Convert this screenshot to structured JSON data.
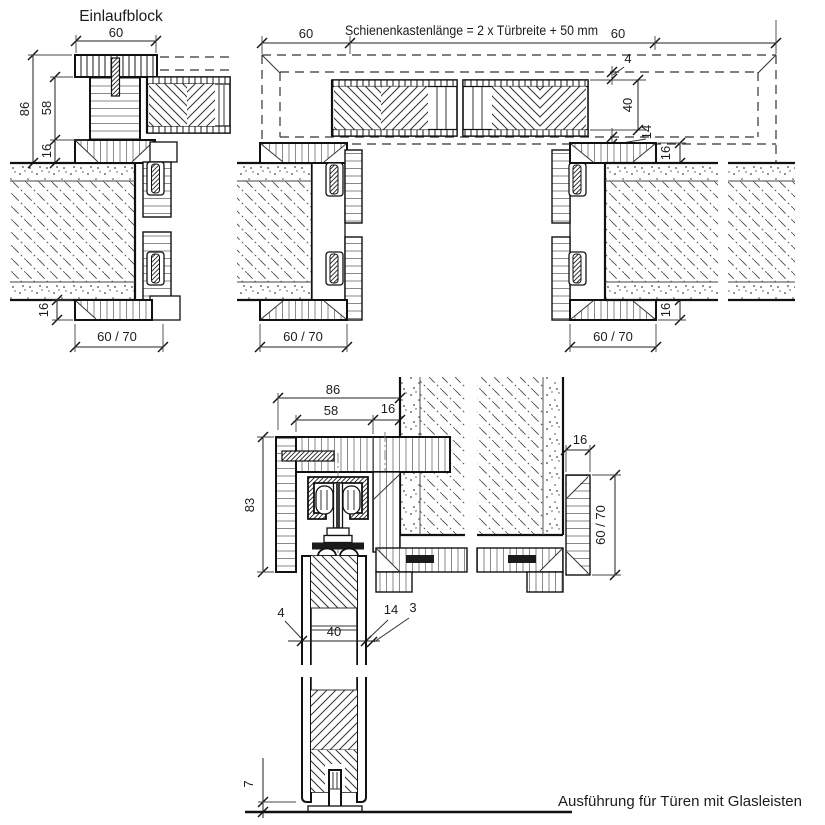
{
  "labels": {
    "einlaufblock": "Einlaufblock",
    "rail_box_formula": "Schienenkastenlänge = 2 x Türbreite + 50 mm",
    "caption": "Ausführung für Türen mit Glasleisten"
  },
  "dims": {
    "plan": {
      "d60_left": "60",
      "d60_right": "60",
      "d86": "86",
      "d58": "58",
      "d16_block": "16",
      "d16_wall_bottom": "16",
      "d60_70_left": "60 / 70",
      "d60_70_mid": "60 / 70",
      "d60_70_right": "60 / 70",
      "d4": "4",
      "d40": "40",
      "d14": "14",
      "d16_frame_top": "16",
      "d16_frame_bottom": "16"
    },
    "section": {
      "d86": "86",
      "d58": "58",
      "d16_lining": "16",
      "d83": "83",
      "d16_frame": "16",
      "d60_70": "60 / 70",
      "d4": "4",
      "d40": "40",
      "d14": "14",
      "d3": "3",
      "d7": "7"
    }
  },
  "colors": {
    "line": "#111111",
    "grain": "#8a8a8a",
    "hatch": "#4a4a4a",
    "background": "#ffffff"
  }
}
